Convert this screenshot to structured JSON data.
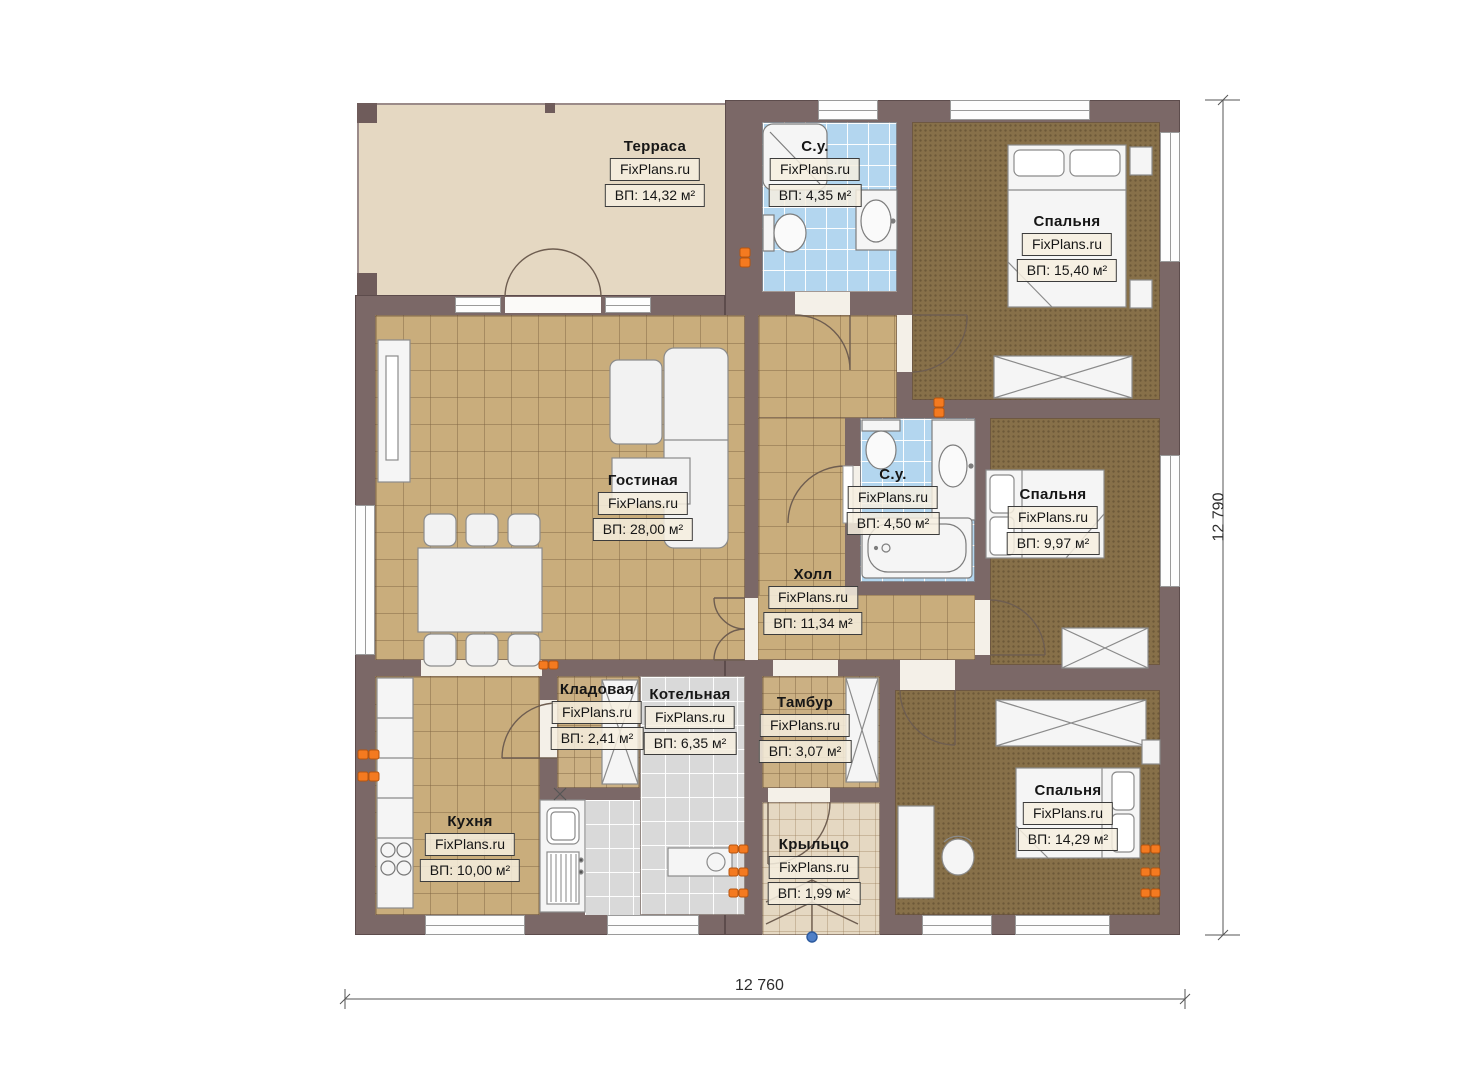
{
  "brand": "FixPlans.ru",
  "dimensions": {
    "width": "12 760",
    "height": "12 790"
  },
  "rooms": {
    "terrace": {
      "name": "Терраса",
      "area": "ВП: 14,32 м²"
    },
    "bath_top": {
      "name": "С.у.",
      "area": "ВП: 4,35 м²"
    },
    "bedroom_top": {
      "name": "Спальня",
      "area": "ВП: 15,40 м²"
    },
    "living": {
      "name": "Гостиная",
      "area": "ВП: 28,00 м²"
    },
    "bath_mid": {
      "name": "С.у.",
      "area": "ВП: 4,50 м²"
    },
    "bedroom_mid": {
      "name": "Спальня",
      "area": "ВП: 9,97 м²"
    },
    "hall": {
      "name": "Холл",
      "area": "ВП: 11,34 м²"
    },
    "pantry": {
      "name": "Кладовая",
      "area": "ВП: 2,41 м²"
    },
    "boiler": {
      "name": "Котельная",
      "area": "ВП: 6,35 м²"
    },
    "vestibule": {
      "name": "Тамбур",
      "area": "ВП: 3,07 м²"
    },
    "kitchen": {
      "name": "Кухня",
      "area": "ВП: 10,00 м²"
    },
    "porch": {
      "name": "Крыльцо",
      "area": "ВП: 1,99 м²"
    },
    "bedroom_bottom": {
      "name": "Спальня",
      "area": "ВП: 14,29 м²"
    }
  },
  "colors": {
    "wall": "#7b6867",
    "floor_tile_tan": "#c9ad7c",
    "floor_carpet": "#877049",
    "floor_tile_blue": "#b3d6ef",
    "floor_tile_gray": "#d9d9d9",
    "terrace_beige": "#e5d8c2",
    "radiator_orange": "#f47a20",
    "entry_marker_blue": "#4f7fc7"
  }
}
